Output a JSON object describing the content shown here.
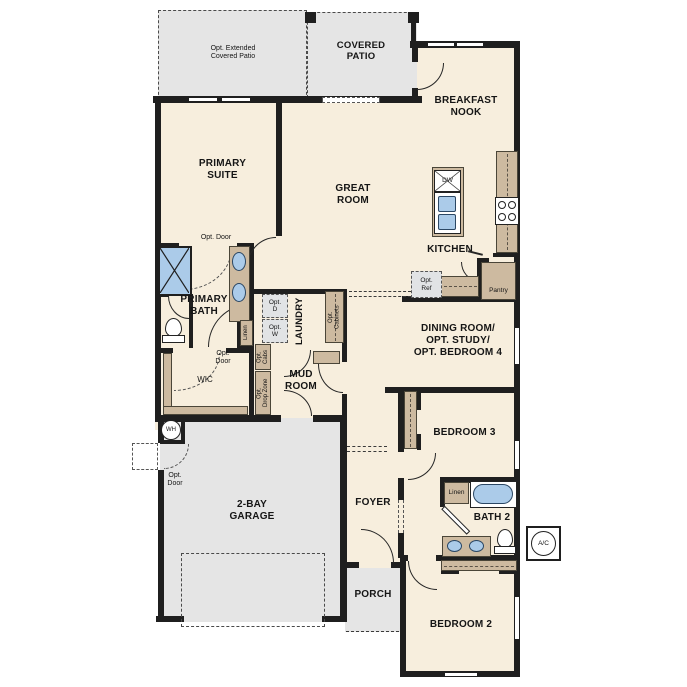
{
  "colors": {
    "floor": "#f7eedd",
    "concrete": "#e5e5e5",
    "wall": "#1f1f1f",
    "cabinetry": "#cdbaa0",
    "fixture_blue": "#abcbe9",
    "optional_gray": "#e1e3e5",
    "text": "#151515"
  },
  "rooms": {
    "primary_suite": "PRIMARY\nSUITE",
    "great_room": "GREAT\nROOM",
    "breakfast_nook": "BREAKFAST\nNOOK",
    "kitchen": "KITCHEN",
    "dining": "DINING ROOM/\nOPT. STUDY/\nOPT. BEDROOM 4",
    "primary_bath": "PRIMARY\nBATH",
    "wic": "WIC",
    "laundry": "LAUNDRY",
    "mud_room": "MUD\nROOM",
    "bedroom3": "BEDROOM 3",
    "bath2": "BATH 2",
    "bedroom2": "BEDROOM 2",
    "foyer": "FOYER",
    "porch": "PORCH",
    "garage": "2-BAY\nGARAGE",
    "covered_patio": "COVERED\nPATIO",
    "opt_extended_patio": "Opt. Extended\nCovered Patio"
  },
  "annotations": {
    "opt_door": "Opt. Door",
    "opt_door_stacked": "Opt.\nDoor",
    "linen": "Linen",
    "pantry": "Pantry",
    "opt_ref": "Opt.\nRef",
    "opt_d": "Opt.\nD",
    "opt_w": "Opt.\nW",
    "opt_cabinets": "Opt.\nCabinets",
    "opt_cabs": "Opt.\nCabs",
    "opt_drop_zone": "Opt.\nDrop Zone"
  },
  "equipment": {
    "water_heater": "WH",
    "ac_unit": "A/C",
    "dishwasher": "DW"
  }
}
